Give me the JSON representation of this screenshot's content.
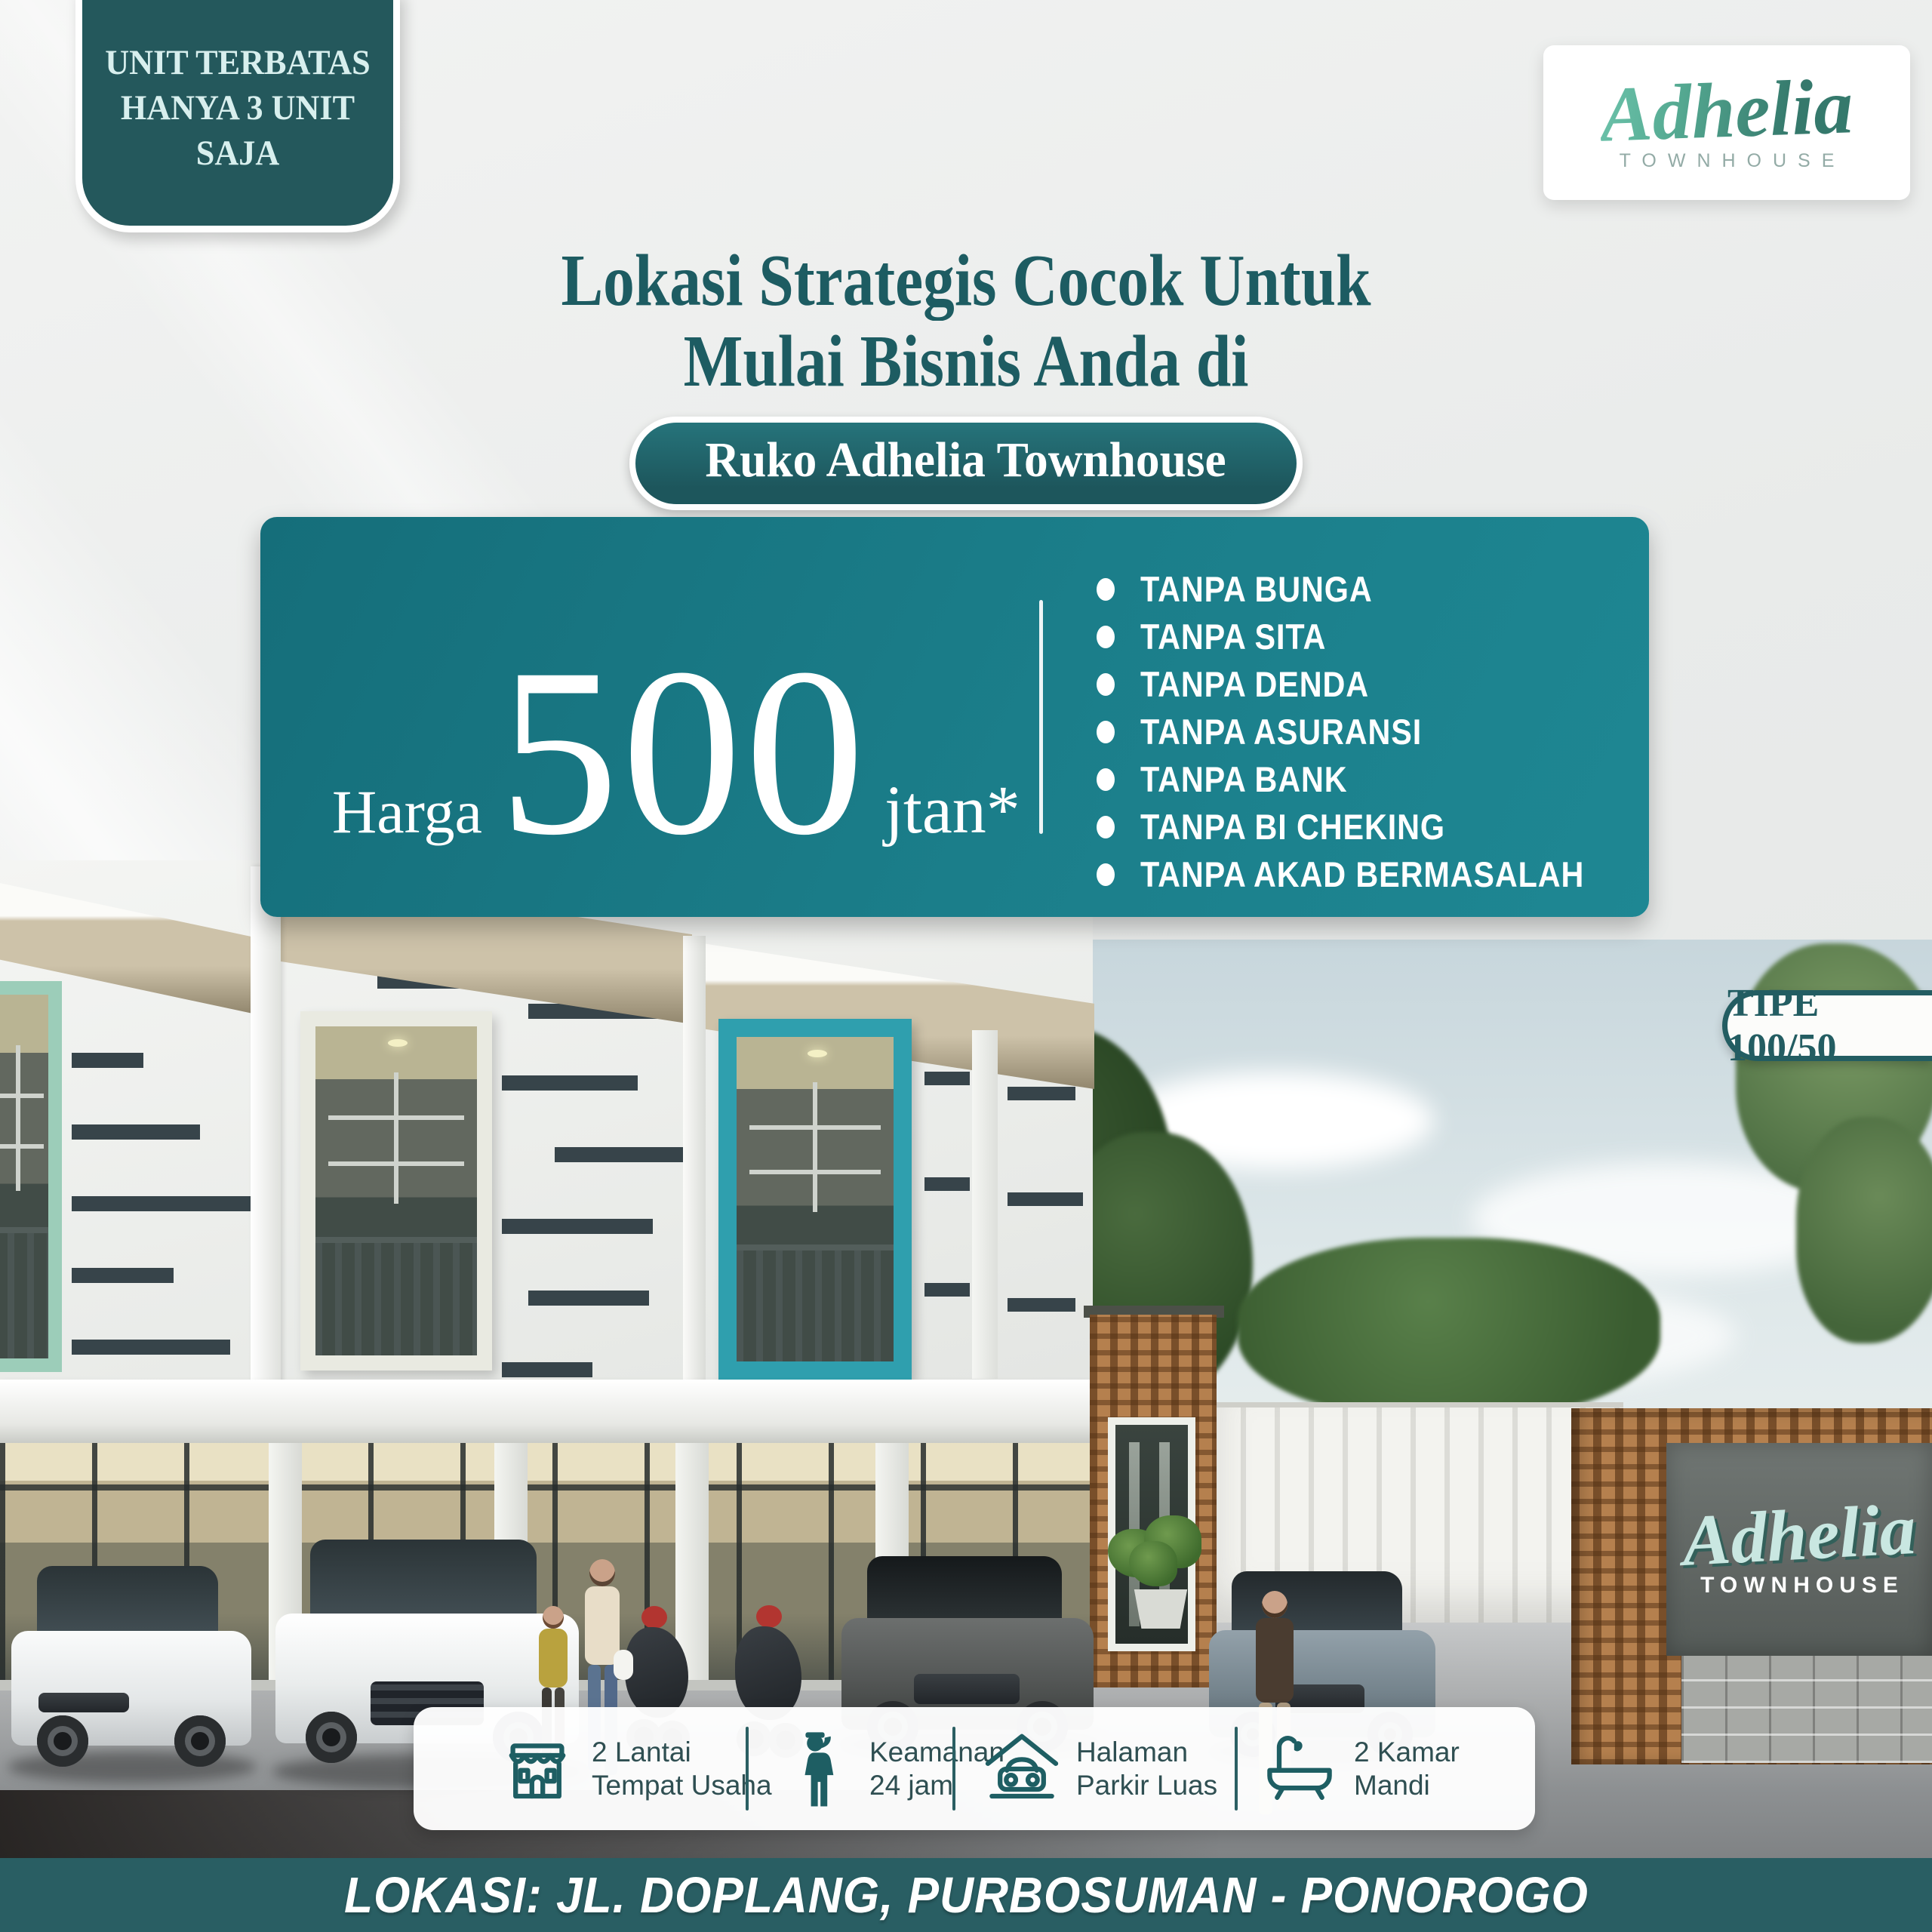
{
  "badge": {
    "line1": "UNIT TERBATAS",
    "line2": "HANYA 3 UNIT SAJA"
  },
  "logo": {
    "name": "Adhelia",
    "subtitle": "TOWNHOUSE"
  },
  "heading": {
    "line1": "Lokasi Strategis Cocok Untuk",
    "line2": "Mulai Bisnis Anda di"
  },
  "pill": {
    "label": "Ruko Adhelia Townhouse"
  },
  "offer": {
    "price_prefix": "Harga",
    "price_amount": "500",
    "price_suffix": "jtan*",
    "benefits": [
      "TANPA BUNGA",
      "TANPA SITA",
      "TANPA DENDA",
      "TANPA ASURANSI",
      "TANPA BANK",
      "TANPA BI CHEKING",
      "TANPA AKAD BERMASALAH"
    ]
  },
  "type_badge": {
    "label": "TIPE 100/50"
  },
  "gate_sign": {
    "name": "Adhelia",
    "subtitle": "TOWNHOUSE"
  },
  "features": [
    {
      "icon": "storefront-icon",
      "line1": "2 Lantai",
      "line2": "Tempat Usaha"
    },
    {
      "icon": "security-guard-icon",
      "line1": "Keamanan",
      "line2": "24 jam"
    },
    {
      "icon": "car-garage-icon",
      "line1": "Halaman",
      "line2": "Parkir Luas"
    },
    {
      "icon": "bathtub-icon",
      "line1": "2 Kamar",
      "line2": "Mandi"
    }
  ],
  "footer": {
    "location": "LOKASI: JL. DOPLANG, PURBOSUMAN - PONOROGO"
  },
  "colors": {
    "teal_dark": "#235d62",
    "teal_card": "#1b7e8a",
    "teal_accent": "#2f9fae",
    "mint": "#9ccdb9",
    "logo_teal": "#5bbd9f",
    "brick": "#b5804e",
    "background": "#ededee",
    "white": "#ffffff"
  }
}
